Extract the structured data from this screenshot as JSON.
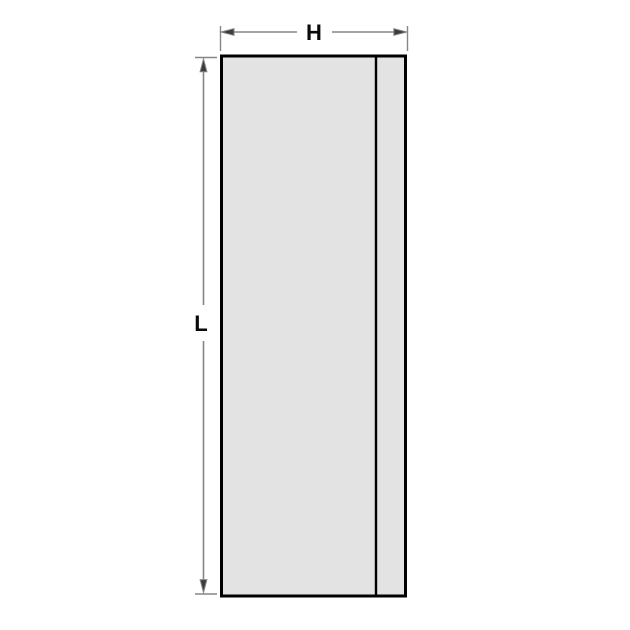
{
  "diagram": {
    "labels": {
      "width_label": "H",
      "length_label": "L"
    },
    "colors": {
      "background": "#ffffff",
      "plate_fill": "#e3e3e3",
      "plate_outline": "#000000",
      "edge_line": "#000000",
      "dimension_line": "#868686",
      "arrow_fill": "#3c3c3c",
      "label_color": "#0a0a0a"
    }
  }
}
